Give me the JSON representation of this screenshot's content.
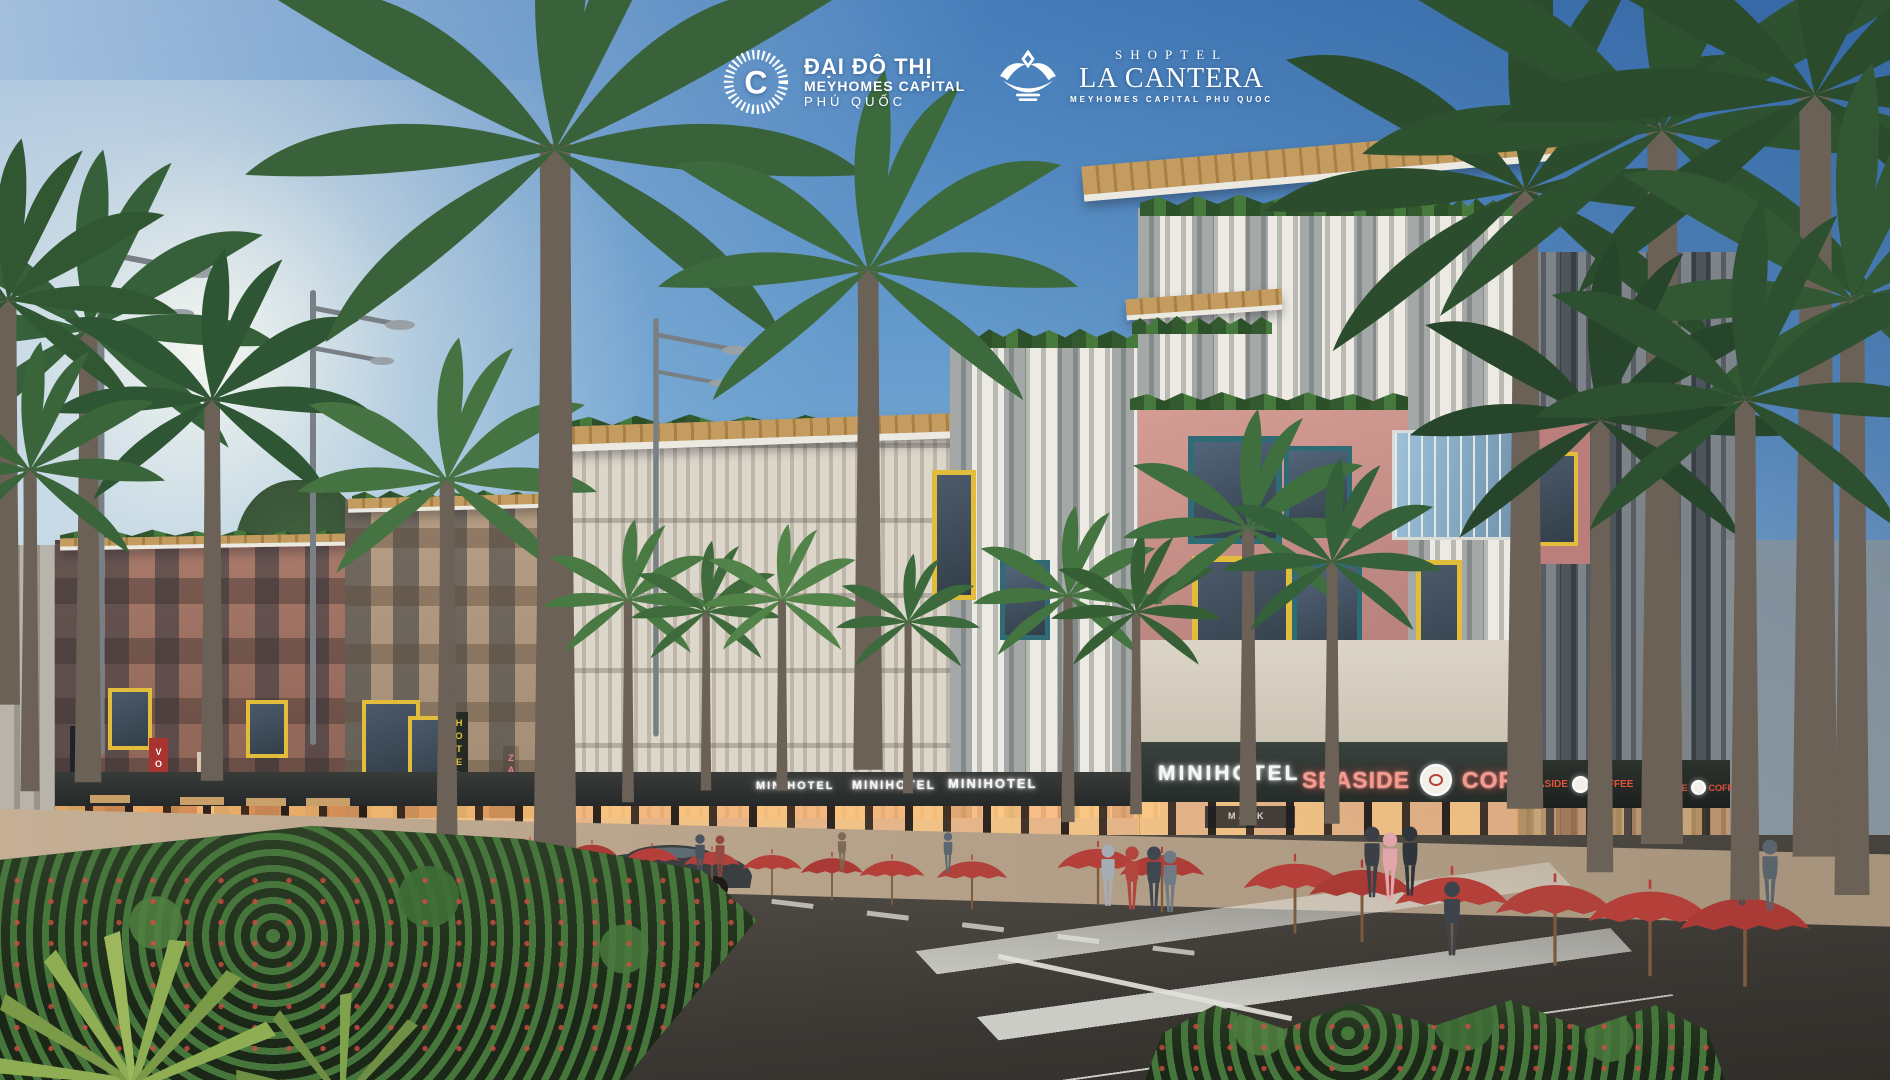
{
  "branding": {
    "dai_do_thi": {
      "icon": "c-sunburst-icon",
      "line1": "ĐẠI ĐÔ THỊ",
      "line2": "MEYHOMES CAPITAL",
      "line3": "PHÚ QUỐC"
    },
    "la_cantera": {
      "icon": "crown-icon",
      "brand": "SHOPTEL",
      "name": "LA CANTERA",
      "tagline": "MEYHOMES CAPITAL PHU QUOC"
    }
  },
  "signs": {
    "vertical": [
      {
        "label": "HOTEL",
        "color": "#e8c53a"
      },
      {
        "label": "VOGUE",
        "color": "#ffffff"
      },
      {
        "label": "ZARA",
        "color": "#b03a34"
      },
      {
        "label": "HOTEL",
        "color": "#e8c53a"
      },
      {
        "label": "ZARA",
        "color": "#e77e96"
      }
    ],
    "fascia": {
      "minihotel": "MINIHOTEL",
      "seaside": "SEASIDE",
      "coffee": "COFFEE",
      "mask": "MASK"
    }
  },
  "palette": {
    "sky_top": "#477fbc",
    "sky_horizon": "#d9e7ef",
    "facade_pink": "#c9908a",
    "facade_terracotta": "#9b7163",
    "accent_yellow": "#e2bd3b",
    "accent_teal": "#2e6b74",
    "umbrella_red": "#b5403a",
    "sign_glow_red": "#f79a90",
    "road": "#4a463f",
    "foliage": "#3c6a3c",
    "wood_canopy": "#c29a5d"
  }
}
